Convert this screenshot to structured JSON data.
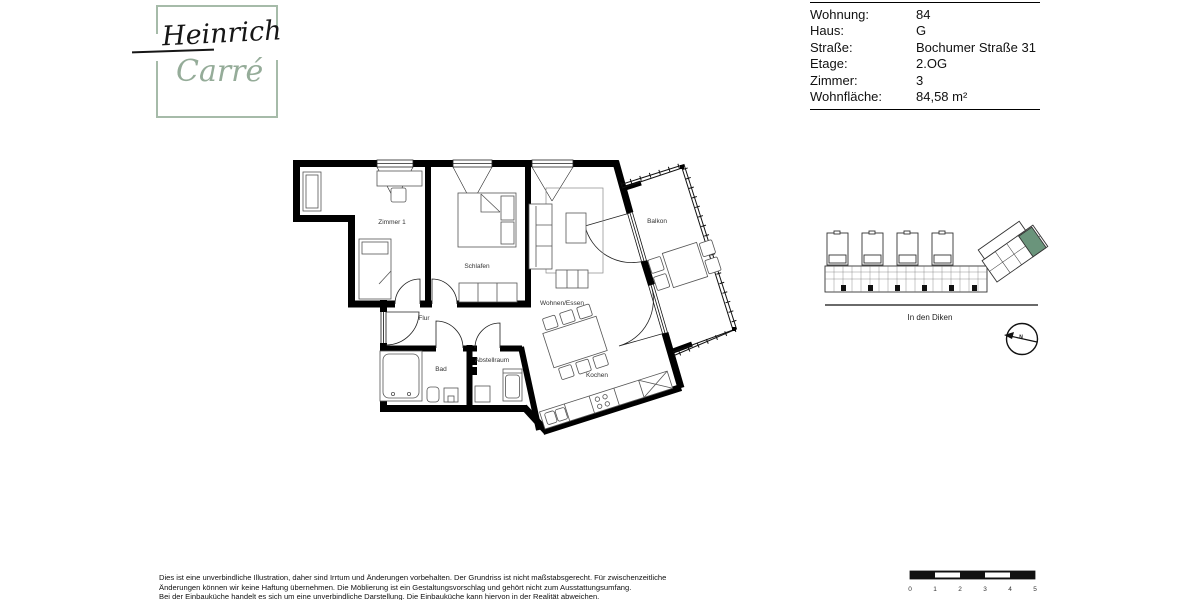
{
  "logo": {
    "line1": "Heinrich",
    "line2": "Carré",
    "frame_color": "#a6bba9",
    "line2_color": "#95ac99"
  },
  "info_table": {
    "rows": [
      {
        "label": "Wohnung:",
        "value": "84"
      },
      {
        "label": "Haus:",
        "value": "G"
      },
      {
        "label": "Straße:",
        "value": "Bochumer Straße 31"
      },
      {
        "label": "Etage:",
        "value": "2.OG"
      },
      {
        "label": "Zimmer:",
        "value": "3"
      },
      {
        "label": "Wohnfläche:",
        "value": "84,58 m²"
      }
    ]
  },
  "floor_plan": {
    "rooms": [
      {
        "name": "Zimmer 1"
      },
      {
        "name": "Schlafen"
      },
      {
        "name": "Flur"
      },
      {
        "name": "Bad"
      },
      {
        "name": "Abstellraum"
      },
      {
        "name": "Wohnen/Essen"
      },
      {
        "name": "Kochen"
      },
      {
        "name": "Balkon"
      }
    ]
  },
  "site_plan": {
    "street_label": "In den Diken",
    "highlight_color": "#6a947b"
  },
  "compass": {
    "label": "N"
  },
  "scale_bar": {
    "labels": [
      "0",
      "1",
      "2",
      "3",
      "4",
      "5"
    ]
  },
  "disclaimer": {
    "lines": [
      "Dies ist eine unverbindliche Illustration, daher sind Irrtum und Änderungen vorbehalten. Der Grundriss ist nicht maßstabsgerecht. Für zwischenzeitliche",
      "Änderungen können wir keine Haftung übernehmen. Die Möblierung ist ein Gestaltungsvorschlag und gehört nicht zum Ausstattungsumfang.",
      "Bei der Einbauküche handelt es sich um eine unverbindliche Darstellung. Die Einbauküche kann hiervon in der Realität abweichen."
    ]
  }
}
